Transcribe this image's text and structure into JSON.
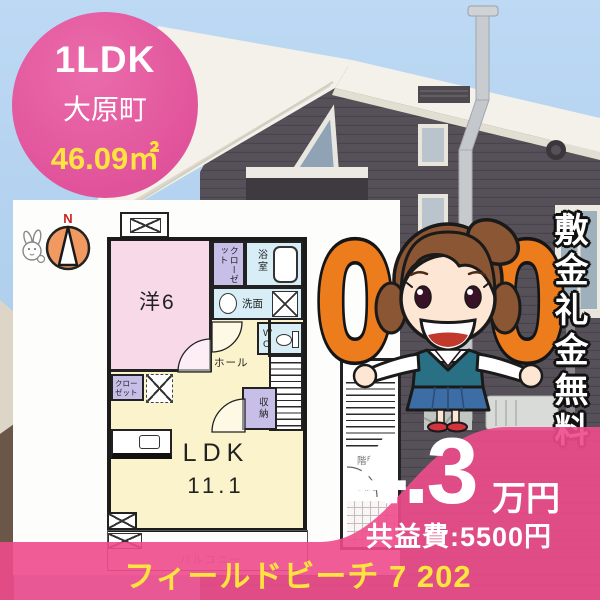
{
  "badge": {
    "layout_type": "1LDK",
    "location": "大原町",
    "area": "46.09㎡"
  },
  "floorplan": {
    "compass_label": "N",
    "western_room": "洋6",
    "closet_upper": "クローゼット",
    "bath": "浴室",
    "washroom": "洗面",
    "toilet": "WC",
    "hall": "ホール",
    "storage": "収納",
    "closet_lower": "クローゼット",
    "ldk_label": "LDK",
    "ldk_size": "11.1",
    "balcony": "バルコニー",
    "stairwell": "階段",
    "entrance": "玄関"
  },
  "promo": {
    "zero_left": "0",
    "zero_right": "0",
    "no_deposit_text": "敷金礼金無料"
  },
  "pricing": {
    "rent": "4.3",
    "rent_unit": "万円",
    "common_fee": "共益費:5500円"
  },
  "property_name": "フィールドビーチ 7 202",
  "colors": {
    "accent_pink": "#e2559c",
    "overlay_pink": "#ee4b8b",
    "highlight_yellow": "#ffe33e",
    "promo_orange": "#ed7c1d"
  }
}
